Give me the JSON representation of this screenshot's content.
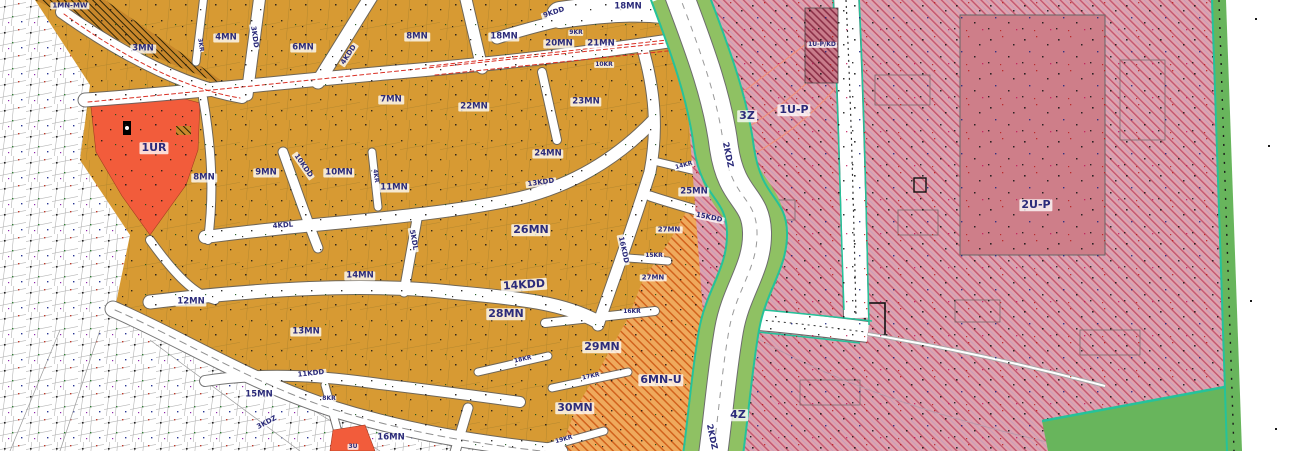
{
  "map_title": "Zoning plan map",
  "palette": {
    "mn_zone": "#D79A33",
    "mn_u_zone_base": "#EFA95C",
    "mn_u_zone_hatch": "#D2631D",
    "ur_zone": "#F25C3B",
    "up_zone_base": "#DFA3AE",
    "up_zone_hatch": "#C4566F",
    "green_strip": "#8FC163",
    "green_edge_strip": "#68B55C",
    "teal_boundary": "#25C29A",
    "road": "#FFFFFF",
    "label_text": "#2B2B7A",
    "hatch_brown": "#C8872B",
    "red_dash": "#D93025"
  },
  "labels": {
    "mnmw1": "1MN-MW",
    "mn3": "3MN",
    "mn4": "4MN",
    "mn6": "6MN",
    "mn8a": "8MN",
    "mn8b": "8MN",
    "mn18a": "18MN",
    "mn18b": "18MN",
    "kdd9": "9KDD",
    "mn20": "20MN",
    "mn21": "21MN",
    "kr9": "9KR",
    "kr10": "10KR",
    "kr3": "3KR",
    "kdd3": "3KDD",
    "kdd4": "4KDD",
    "mn7": "7MN",
    "mn22": "22MN",
    "mn23": "23MN",
    "ur1": "1UR",
    "mn9": "9MN",
    "mn10": "10MN",
    "mn11": "11MN",
    "kr4": "4KR",
    "kdd10": "10KDD",
    "kdl4": "4KDL",
    "kdl5": "5KDL",
    "kdd13": "13KDD",
    "mn24": "24MN",
    "mn25": "25MN",
    "kdd15": "15KDD",
    "kr14": "14KR",
    "mn26": "26MN",
    "mn27a": "27MN",
    "mn27b": "27MN",
    "kr15": "15KR",
    "kdd16": "16KDD",
    "kdd14": "14KDD",
    "mn12": "12MN",
    "mn13": "13MN",
    "mn14": "14MN",
    "kdd11": "11KDD",
    "mn15": "15MN",
    "kr8": "8KR",
    "kdz3": "3KDZ",
    "mn16": "16MN",
    "u3": "3U",
    "mn28": "28MN",
    "kr16": "16KR",
    "mn29": "29MN",
    "kr18": "18KR",
    "kr17": "17KR",
    "mn30": "30MN",
    "kr19": "19KR",
    "mnu6": "6MN-U",
    "z4": "4Z",
    "kdz2a": "2KDZ",
    "kdz2b": "2KDZ",
    "z3": "3Z",
    "up1": "1U-P",
    "up2": "2U-P",
    "upkd": "1U-P/KD"
  }
}
